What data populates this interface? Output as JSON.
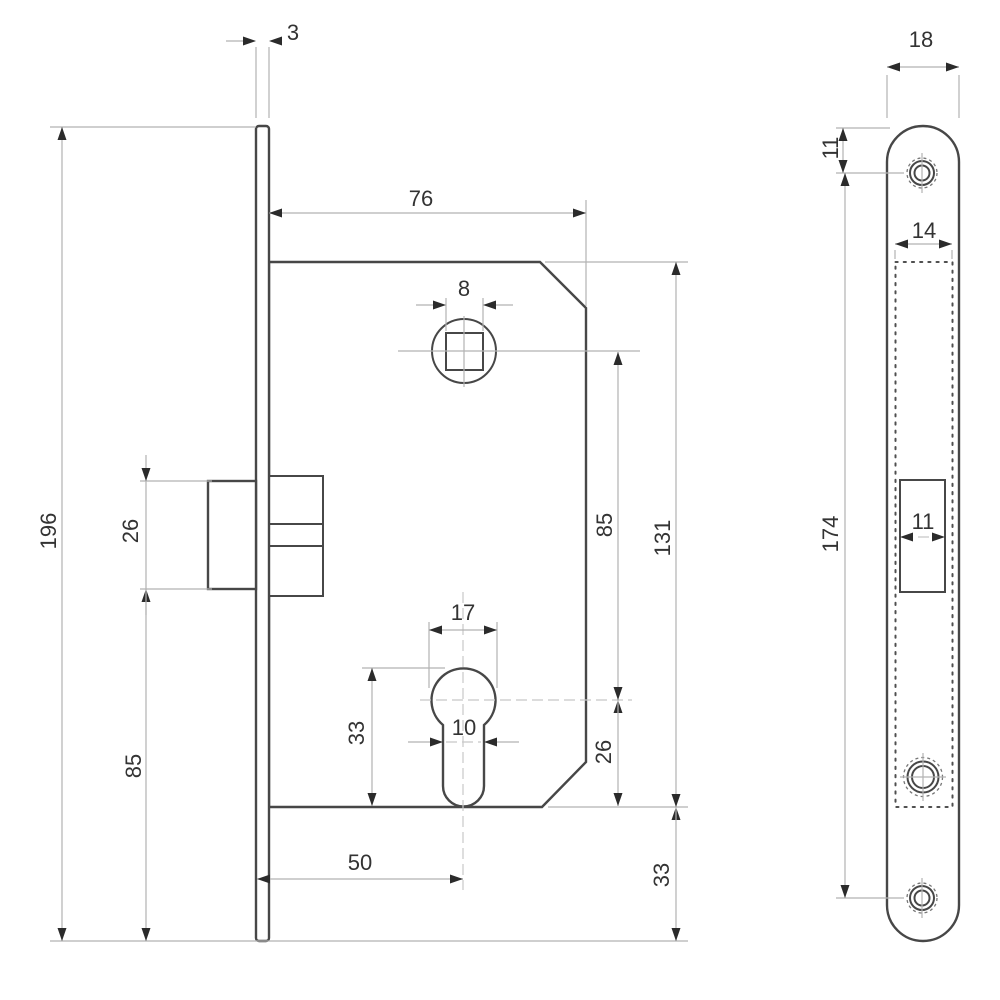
{
  "drawing": {
    "background": "#ffffff",
    "outline_color": "#474747",
    "dim_line_color": "#b2b2b2",
    "text_color": "#333333",
    "side_view": {
      "dims": {
        "faceplate_thickness": "3",
        "case_depth": "76",
        "spindle_square": "8",
        "faceplate_length": "196",
        "latch_height": "26",
        "latch_to_plate_bottom": "85",
        "cylinder_diameter": "17",
        "cylinder_profile_height": "33",
        "cylinder_stem_width": "10",
        "backset": "50",
        "spindle_to_cylinder": "85",
        "case_length": "131",
        "cylinder_to_case_bottom": "26",
        "case_to_plate_bottom": "33"
      }
    },
    "front_view": {
      "dims": {
        "plate_width": "18",
        "plate_top_to_screw": "11",
        "mortise_width": "14",
        "screw_centers": "174",
        "latch_width": "11"
      }
    }
  }
}
